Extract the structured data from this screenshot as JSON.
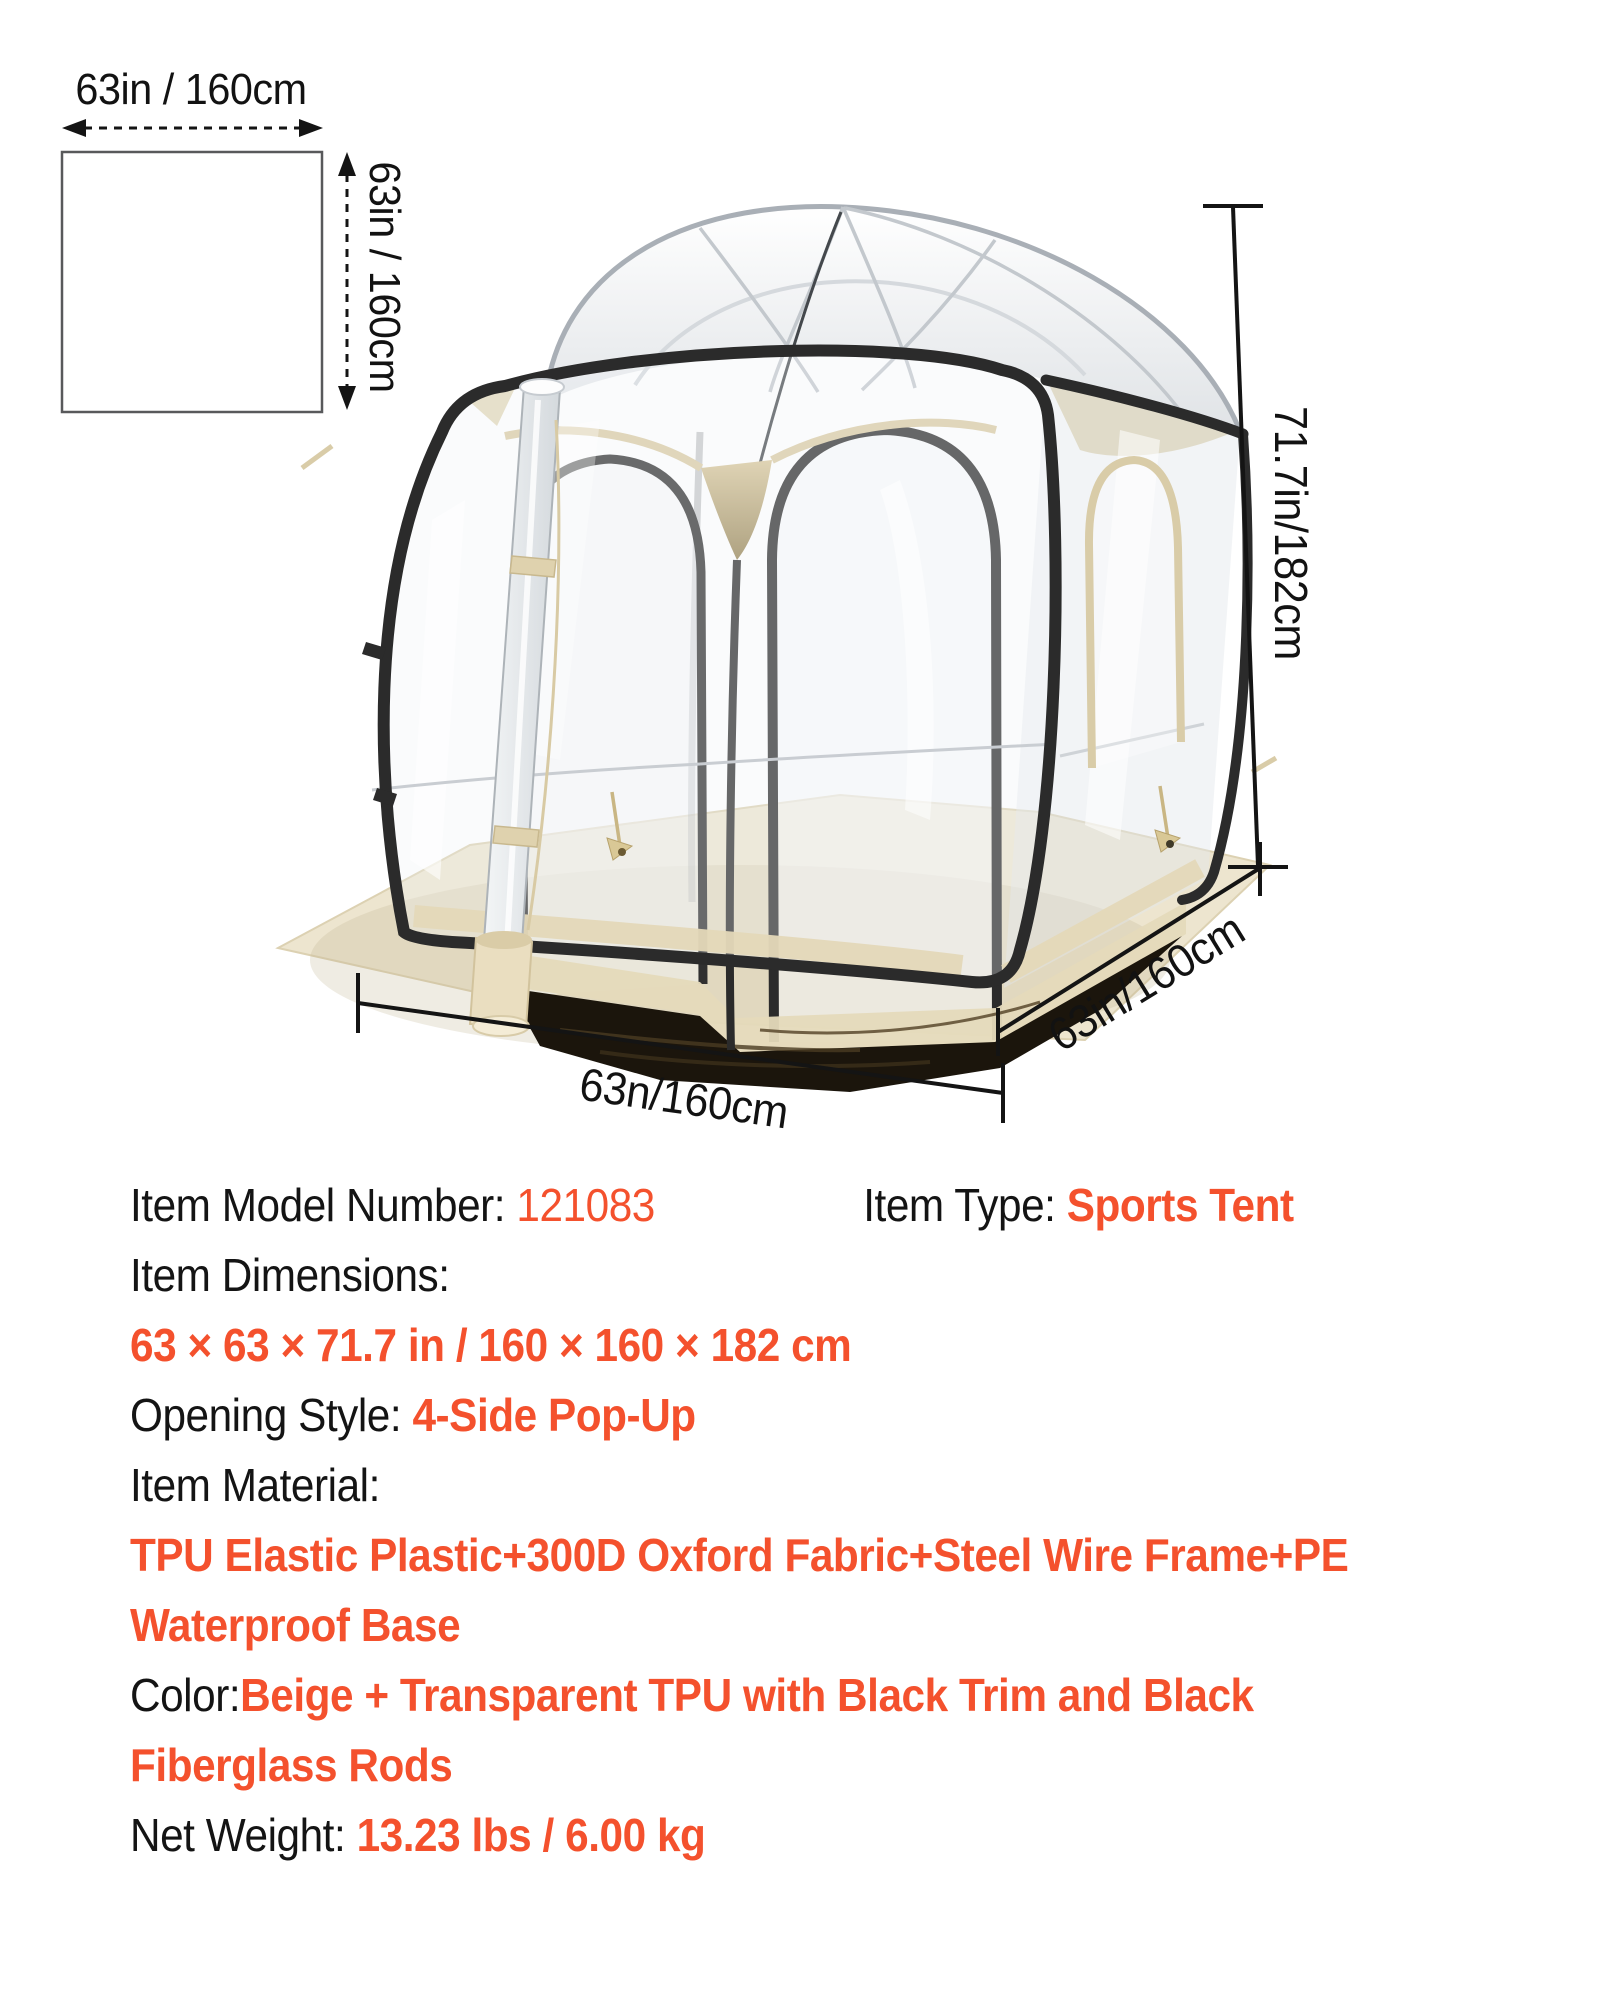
{
  "colors": {
    "accent": "#F4512D",
    "text": "#141414",
    "trim_black": "#2B2B2B",
    "beige_fabric": "#E4D8B8",
    "ground_tarp": "#EDE5CF"
  },
  "diagram": {
    "width_label": "63in / 160cm",
    "height_label": "63in / 160cm"
  },
  "tent": {
    "height_label": "71.7in/182cm",
    "front_width_label": "63n/160cm",
    "depth_label": "63in/160cm"
  },
  "specs": {
    "model_label": "Item Model Number: ",
    "model_value": "121083",
    "type_label": "Item Type: ",
    "type_value": "Sports Tent",
    "dimensions_label": "Item Dimensions:",
    "dimensions_value": "63 × 63 × 71.7 in / 160 × 160 × 182 cm",
    "opening_label": "Opening Style: ",
    "opening_value": "4-Side Pop-Up",
    "material_label": "Item Material:",
    "material_value_line1": "TPU Elastic Plastic+300D Oxford Fabric+Steel Wire Frame+PE",
    "material_value_line2": "Waterproof Base",
    "color_label": "Color:",
    "color_value_line1": "Beige + Transparent TPU with Black Trim and Black",
    "color_value_line2": "Fiberglass Rods",
    "weight_label": "Net Weight: ",
    "weight_value": "13.23 lbs / 6.00 kg"
  }
}
